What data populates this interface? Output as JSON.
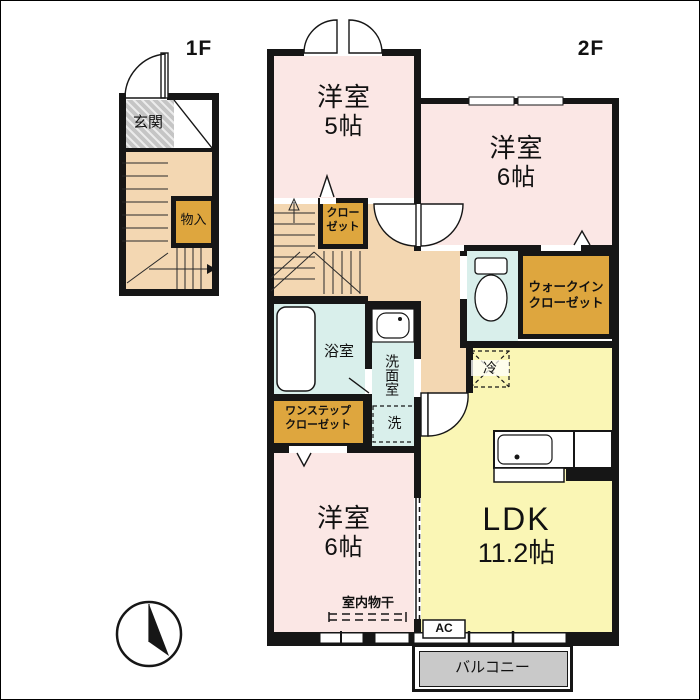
{
  "colors": {
    "wall": "#161616",
    "pink": "#fbe7e5",
    "tan": "#f3d7b2",
    "yellow": "#faf6b5",
    "cyan": "#d9efeb",
    "orange": "#dea63e",
    "gray_genkan": "#c5c5c5",
    "gray_balcony": "#c9c9c9"
  },
  "header": {
    "floor1": "1F",
    "floor2": "2F"
  },
  "rooms": {
    "genkan": {
      "label": "玄関"
    },
    "monoire": {
      "label": "物入"
    },
    "yoshitsu5": {
      "label": "洋室",
      "size": "5帖"
    },
    "yoshitsu6_upper": {
      "label": "洋室",
      "size": "6帖"
    },
    "yoshitsu6_lower": {
      "label": "洋室",
      "size": "6帖"
    },
    "ldk": {
      "label": "LDK",
      "size": "11.2帖"
    },
    "closet": {
      "line1": "クロー",
      "line2": "ゼット"
    },
    "walkin_closet": {
      "line1": "ウォークイン",
      "line2": "クローゼット"
    },
    "onestep_closet": {
      "line1": "ワンステップ",
      "line2": "クローゼット"
    },
    "bathroom": {
      "label": "浴室"
    },
    "washroom": {
      "label": "洗面室"
    },
    "balcony": {
      "label": "バルコニー"
    }
  },
  "fixtures": {
    "washer": "洗",
    "fridge": "冷",
    "ac": "AC",
    "indoor_drying": "室内物干"
  }
}
